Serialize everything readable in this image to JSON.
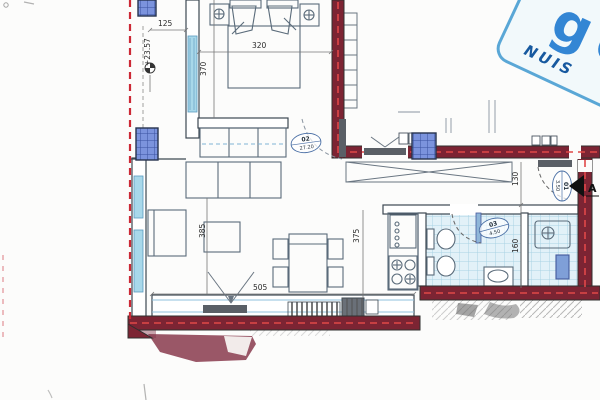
{
  "plan": {
    "type": "apartment floor plan scan",
    "dimensions": {
      "balcony_width": "125",
      "bed_width": "320",
      "bedroom_depth": "370",
      "living_width": "385",
      "kitchen_depth": "375",
      "living_length": "505",
      "hall_depth": "130",
      "bath_depth": "160"
    },
    "levels": {
      "terrace_level": "+23.57"
    },
    "rooms": {
      "living": {
        "number": "02",
        "area": "27.20"
      },
      "hall": {
        "number": "01",
        "area": "3.50"
      },
      "wc": {
        "number": "03",
        "area": "4.50"
      }
    },
    "section": {
      "label": "A"
    },
    "stamp": {
      "big_text": "gen",
      "sub_text": "NUIS"
    },
    "colors": {
      "wall_fill": "#7c2433",
      "wall_centerline": "#e04848",
      "boundary_dash": "#cc2936",
      "column_fill": "#7b93dd",
      "window_glazing": "#a8d8ea",
      "tile_fill": "#e2f1f8",
      "stamp_blue": "#1f7ad0",
      "drawing_line": "#54616e"
    }
  }
}
